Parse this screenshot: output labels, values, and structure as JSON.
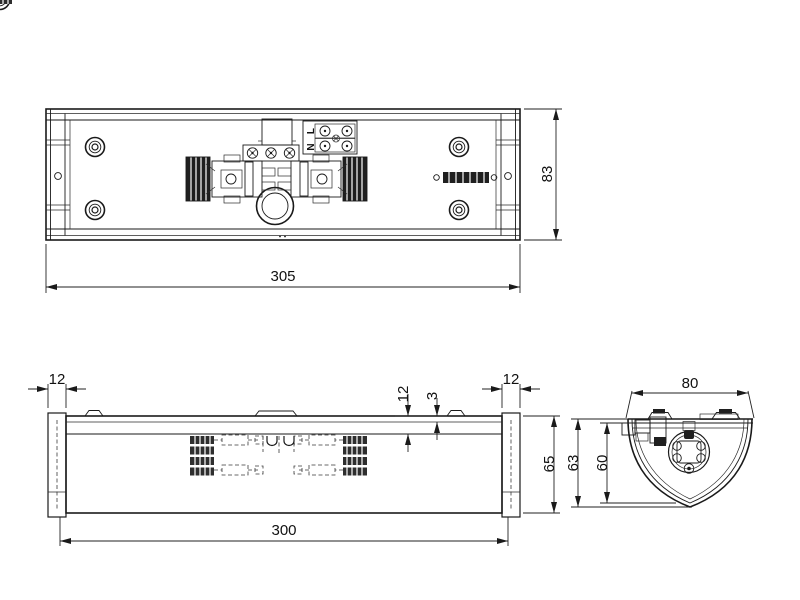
{
  "drawing": {
    "background_color": "#ffffff",
    "line_color": "#1a1a1a",
    "top_view": {
      "length_dim": "305",
      "height_dim": "83",
      "terminal_live_label": "L",
      "terminal_neutral_label": "N"
    },
    "front_view": {
      "length_dim": "300",
      "height_dim": "65",
      "left_endcap_dim": "12",
      "right_endcap_dim": "12",
      "recess_dim": "12",
      "lip_dim": "3"
    },
    "side_view": {
      "width_dim": "80",
      "outer_height_dim": "63",
      "inner_height_dim": "60"
    }
  }
}
